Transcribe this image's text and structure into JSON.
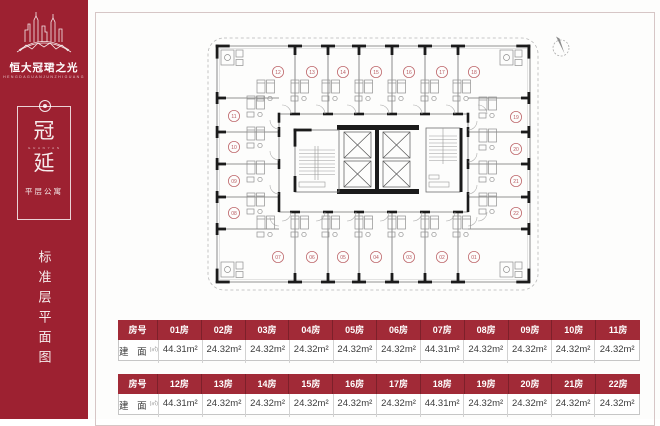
{
  "colors": {
    "sidebar_bg": "#9d2131",
    "table_header_bg": "#a12a37",
    "unit_number_red": "#b85a60",
    "wall_black": "#1b1b1b"
  },
  "sidebar": {
    "brand": "恒大冠珺之光",
    "brand_caption": "HENGDAGUANJUNZHIGUANG",
    "emblem": {
      "char_top": "冠",
      "small_caption": "G U A N Y A N",
      "char_bottom": "延",
      "subtitle": "平层公寓"
    },
    "vertical_title": "标准层平面图"
  },
  "plan": {
    "units": [
      {
        "no": "12",
        "x": 83,
        "y": 54,
        "side": "top"
      },
      {
        "no": "13",
        "x": 117,
        "y": 54,
        "side": "top"
      },
      {
        "no": "14",
        "x": 148,
        "y": 54,
        "side": "top"
      },
      {
        "no": "15",
        "x": 181,
        "y": 54,
        "side": "top"
      },
      {
        "no": "16",
        "x": 214,
        "y": 54,
        "side": "top"
      },
      {
        "no": "17",
        "x": 247,
        "y": 54,
        "side": "top"
      },
      {
        "no": "18",
        "x": 279,
        "y": 54,
        "side": "top"
      },
      {
        "no": "11",
        "x": 39,
        "y": 98,
        "side": "left"
      },
      {
        "no": "10",
        "x": 39,
        "y": 129,
        "side": "left"
      },
      {
        "no": "09",
        "x": 39,
        "y": 163,
        "side": "left"
      },
      {
        "no": "08",
        "x": 39,
        "y": 195,
        "side": "left"
      },
      {
        "no": "19",
        "x": 321,
        "y": 99,
        "side": "right"
      },
      {
        "no": "20",
        "x": 321,
        "y": 131,
        "side": "right"
      },
      {
        "no": "21",
        "x": 321,
        "y": 163,
        "side": "right"
      },
      {
        "no": "22",
        "x": 321,
        "y": 195,
        "side": "right"
      },
      {
        "no": "07",
        "x": 83,
        "y": 239,
        "side": "bottom"
      },
      {
        "no": "06",
        "x": 117,
        "y": 239,
        "side": "bottom"
      },
      {
        "no": "05",
        "x": 148,
        "y": 239,
        "side": "bottom"
      },
      {
        "no": "04",
        "x": 181,
        "y": 239,
        "side": "bottom"
      },
      {
        "no": "03",
        "x": 214,
        "y": 239,
        "side": "bottom"
      },
      {
        "no": "02",
        "x": 247,
        "y": 239,
        "side": "bottom"
      },
      {
        "no": "01",
        "x": 279,
        "y": 239,
        "side": "bottom"
      }
    ]
  },
  "tables": [
    {
      "row_label": "房号",
      "area_label": "建 面",
      "area_unit": "(㎡)",
      "rooms": [
        "01房",
        "02房",
        "03房",
        "04房",
        "05房",
        "06房",
        "07房",
        "08房",
        "09房",
        "10房",
        "11房"
      ],
      "areas": [
        "44.31m²",
        "24.32m²",
        "24.32m²",
        "24.32m²",
        "24.32m²",
        "24.32m²",
        "44.31m²",
        "24.32m²",
        "24.32m²",
        "24.32m²",
        "24.32m²"
      ]
    },
    {
      "row_label": "房号",
      "area_label": "建 面",
      "area_unit": "(㎡)",
      "rooms": [
        "12房",
        "13房",
        "14房",
        "15房",
        "16房",
        "17房",
        "18房",
        "19房",
        "20房",
        "21房",
        "22房"
      ],
      "areas": [
        "44.31m²",
        "24.32m²",
        "24.32m²",
        "24.32m²",
        "24.32m²",
        "24.32m²",
        "44.31m²",
        "24.32m²",
        "24.32m²",
        "24.32m²",
        "24.32m²"
      ]
    }
  ]
}
